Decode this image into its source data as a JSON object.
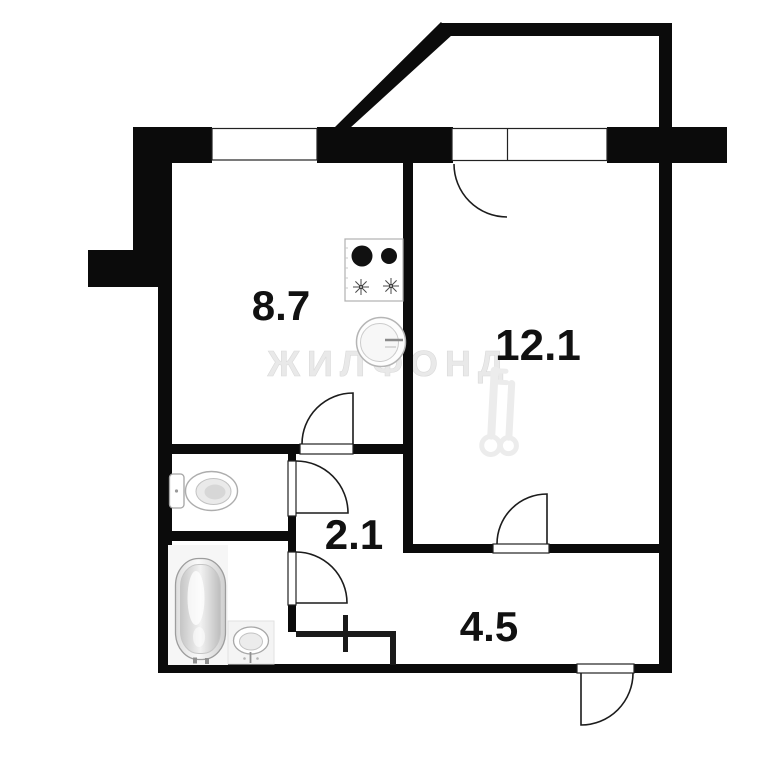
{
  "plan": {
    "type": "apartment-floor-plan",
    "watermark": {
      "text": "ЖИЛФОНД"
    },
    "rooms": [
      {
        "name": "kitchen",
        "area": "8.7"
      },
      {
        "name": "living-room",
        "area": "12.1"
      },
      {
        "name": "hallway",
        "area": "2.1"
      },
      {
        "name": "corridor",
        "area": "4.5"
      }
    ],
    "fixtures": [
      "stove",
      "kitchen-sink",
      "toilet",
      "bathtub",
      "bathroom-sink"
    ],
    "features": [
      "balcony-with-angled-wall",
      "balcony-door-and-window",
      "kitchen-window",
      "entrance-door",
      "duct-riser-cross"
    ],
    "colors": {
      "background": "#ffffff",
      "wall": "#0b0b0b",
      "line": "#1c1c1c",
      "label": "#111111",
      "fixture_stroke": "#a9a9a9",
      "watermark": "#e9e9e9"
    }
  }
}
